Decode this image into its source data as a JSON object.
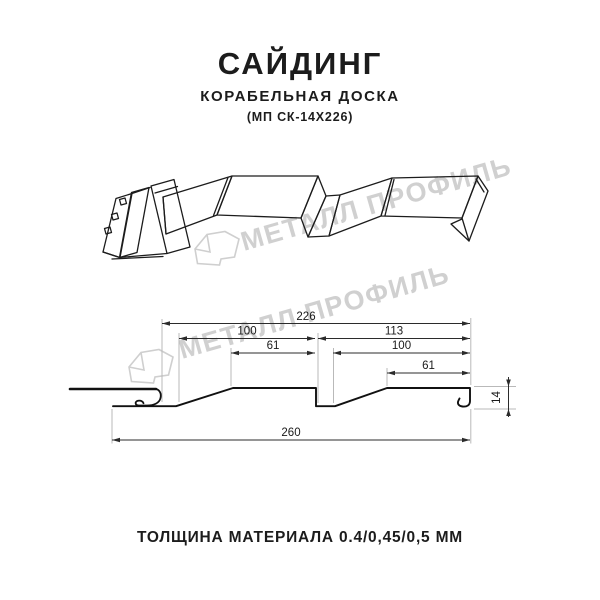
{
  "title": {
    "main": "САЙДИНГ",
    "subtitle": "КОРАБЕЛЬНАЯ ДОСКА",
    "model": "(МП СК-14Х226)"
  },
  "watermark": {
    "brand": "МЕТАЛЛ ПРОФИЛЬ",
    "color": "#d0d0d0"
  },
  "diagram": {
    "type": "technical-profile-drawing",
    "dims": {
      "module": "226",
      "left_100": "100",
      "left_61": "61",
      "right_113": "113",
      "right_100": "100",
      "right_61": "61",
      "total": "260",
      "height": "14"
    }
  },
  "footer": {
    "text": "ТОЛЩИНА МАТЕРИАЛА 0.4/0,45/0,5 ММ"
  }
}
